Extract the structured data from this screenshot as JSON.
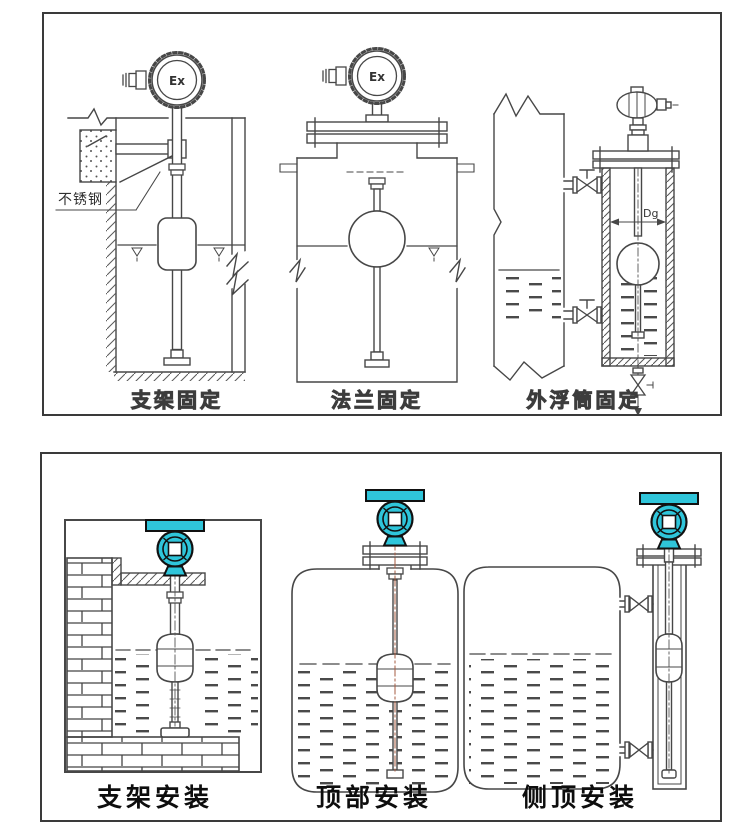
{
  "page": {
    "background": "#ffffff"
  },
  "colors": {
    "line": "#474747",
    "panel_border": "#3a3a3a",
    "transmitter_teal": "#2fc5da",
    "centerline_red": "#a65b40"
  },
  "top_panel": {
    "diagrams": {
      "bracket": {
        "label": "支架固定",
        "material_note": "不锈钢",
        "ex_mark": "Ex"
      },
      "flange": {
        "label": "法兰固定",
        "ex_mark": "Ex"
      },
      "external_chamber": {
        "label": "外浮筒固定",
        "diameter_label": "Dg"
      }
    }
  },
  "bottom_panel": {
    "diagrams": {
      "bracket": {
        "label": "支架安装"
      },
      "top_mount": {
        "label": "顶部安装"
      },
      "side_top_mount": {
        "label": "侧顶安装"
      }
    }
  }
}
